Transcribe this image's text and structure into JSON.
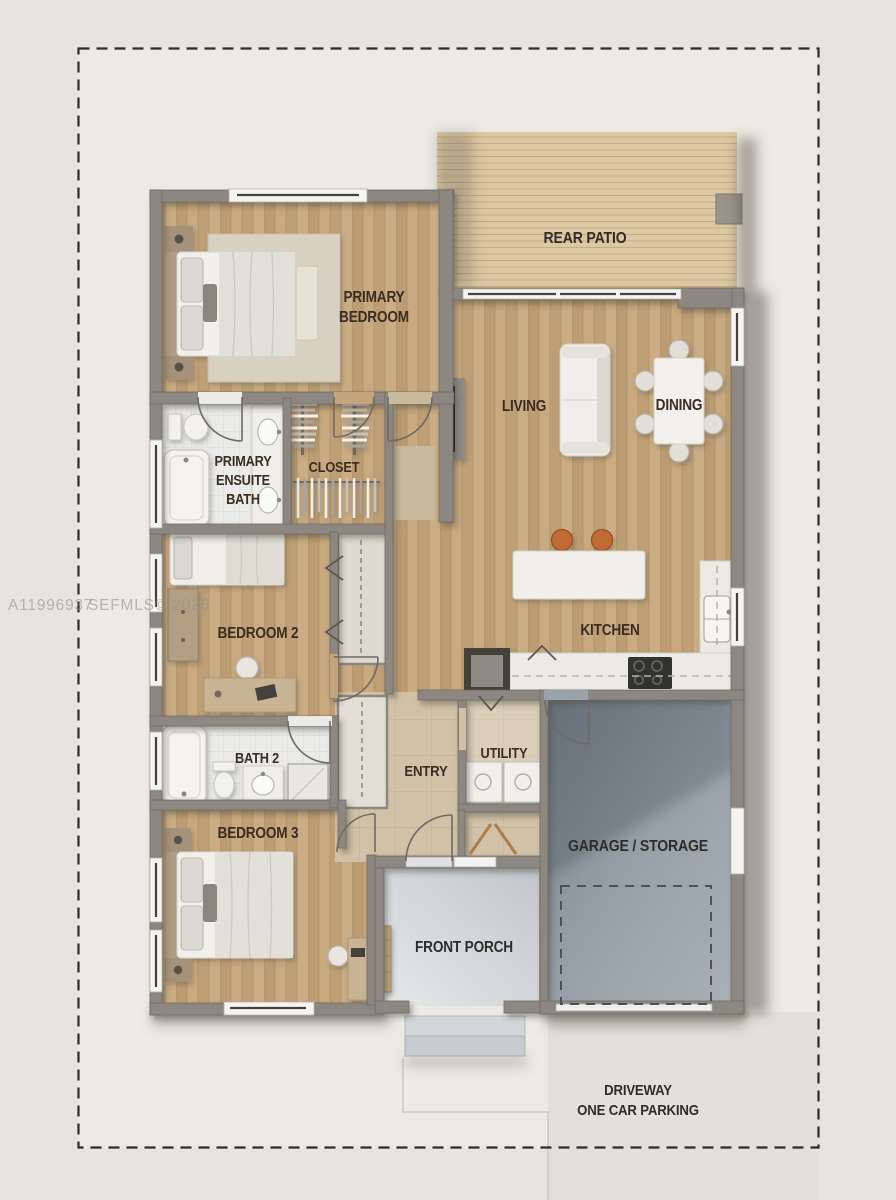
{
  "plan": {
    "type": "single-story-house-floor-plan",
    "watermark": {
      "part1": "A11996937",
      "part2": "SEFMLS© 2026"
    },
    "labels": {
      "rear_patio": "REAR PATIO",
      "primary_bedroom": [
        "PRIMARY",
        "BEDROOM"
      ],
      "living": "LIVING",
      "dining": "DINING",
      "primary_ensuite_bath": [
        "PRIMARY",
        "ENSUITE",
        "BATH"
      ],
      "closet": "CLOSET",
      "bedroom2": "BEDROOM 2",
      "kitchen": "KITCHEN",
      "bath2": "BATH 2",
      "entry": "ENTRY",
      "utility": "UTILITY",
      "bedroom3": "BEDROOM 3",
      "garage": "GARAGE / STORAGE",
      "front_porch": "FRONT PORCH",
      "driveway": [
        "DRIVEWAY",
        "ONE CAR PARKING"
      ]
    },
    "colors": {
      "background": "#e7e4df",
      "site": "#edeae4",
      "wood_floor": "#c3a47b",
      "deck": "#ddc8a4",
      "wall": "#8d8781",
      "entry_tile": "#d1c1a6",
      "bath_floor": "#eaeae8",
      "garage_concrete": "#97a0a8",
      "porch_concrete": "#d4d8db",
      "stool_accent": "#c06a35",
      "room_label_text": "#3a2d22",
      "site_label_text": "#2f2d29",
      "boundary_line": "#2c2c2a"
    }
  }
}
